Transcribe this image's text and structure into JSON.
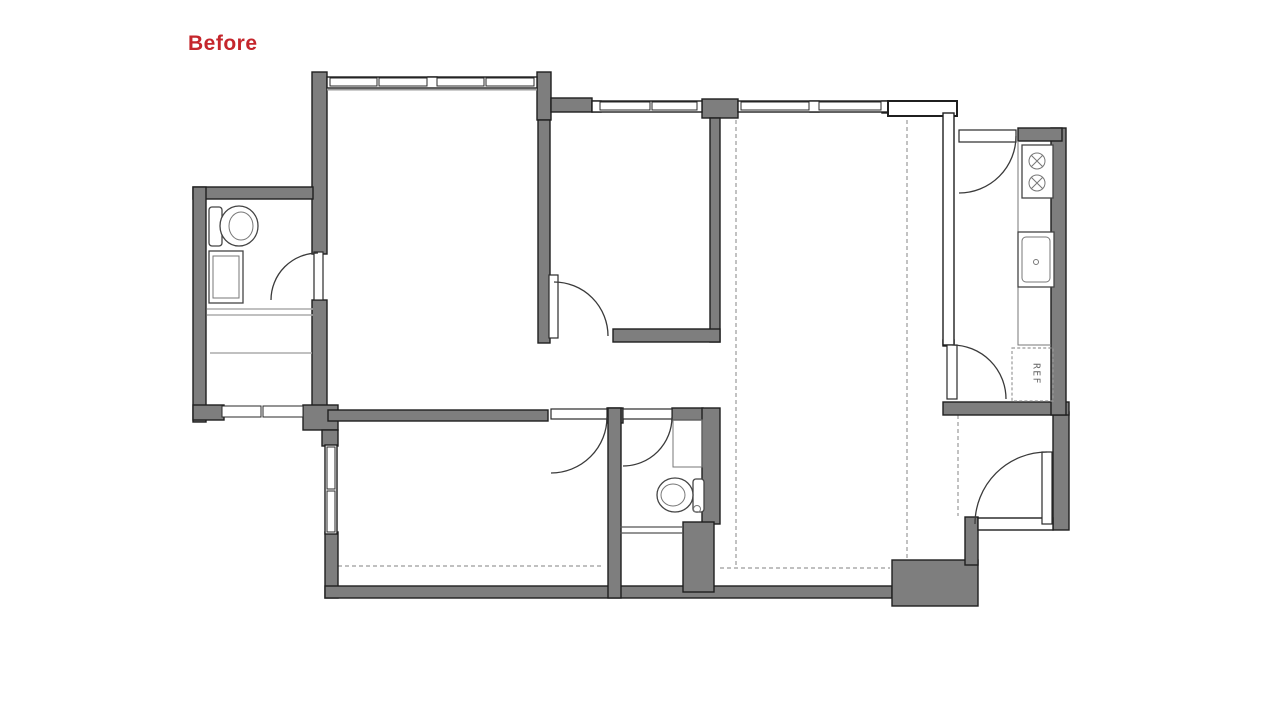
{
  "header": {
    "state_label": "Before"
  },
  "kitchen": {
    "ref_label": "REF"
  },
  "colors": {
    "wall_fill": "#7e7e7e",
    "wall_outline": "#1f1f1f",
    "accent_red": "#c5262c",
    "line_gray": "#9a9a9a",
    "background": "#ffffff"
  }
}
